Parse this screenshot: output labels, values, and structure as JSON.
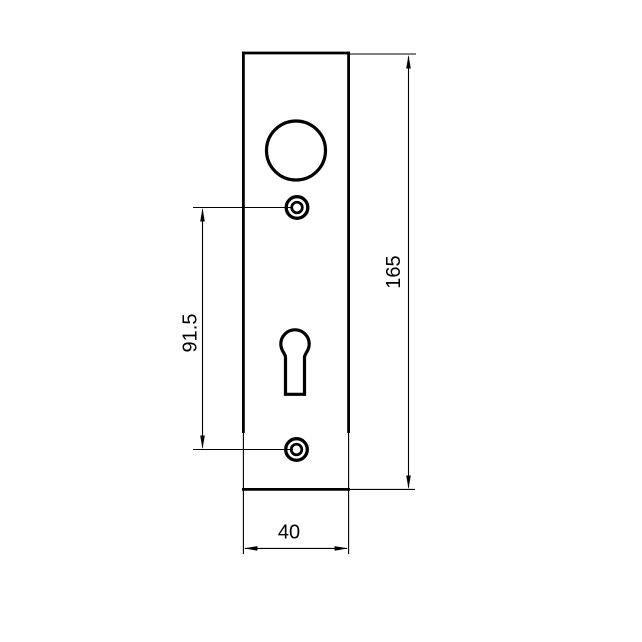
{
  "drawing": {
    "kind": "door-plate-technical-drawing",
    "dimensions": {
      "overall_height": "165",
      "hole_spacing": "91.5",
      "plate_width": "40"
    },
    "colors": {
      "line": "#000000",
      "background": "#ffffff"
    }
  }
}
